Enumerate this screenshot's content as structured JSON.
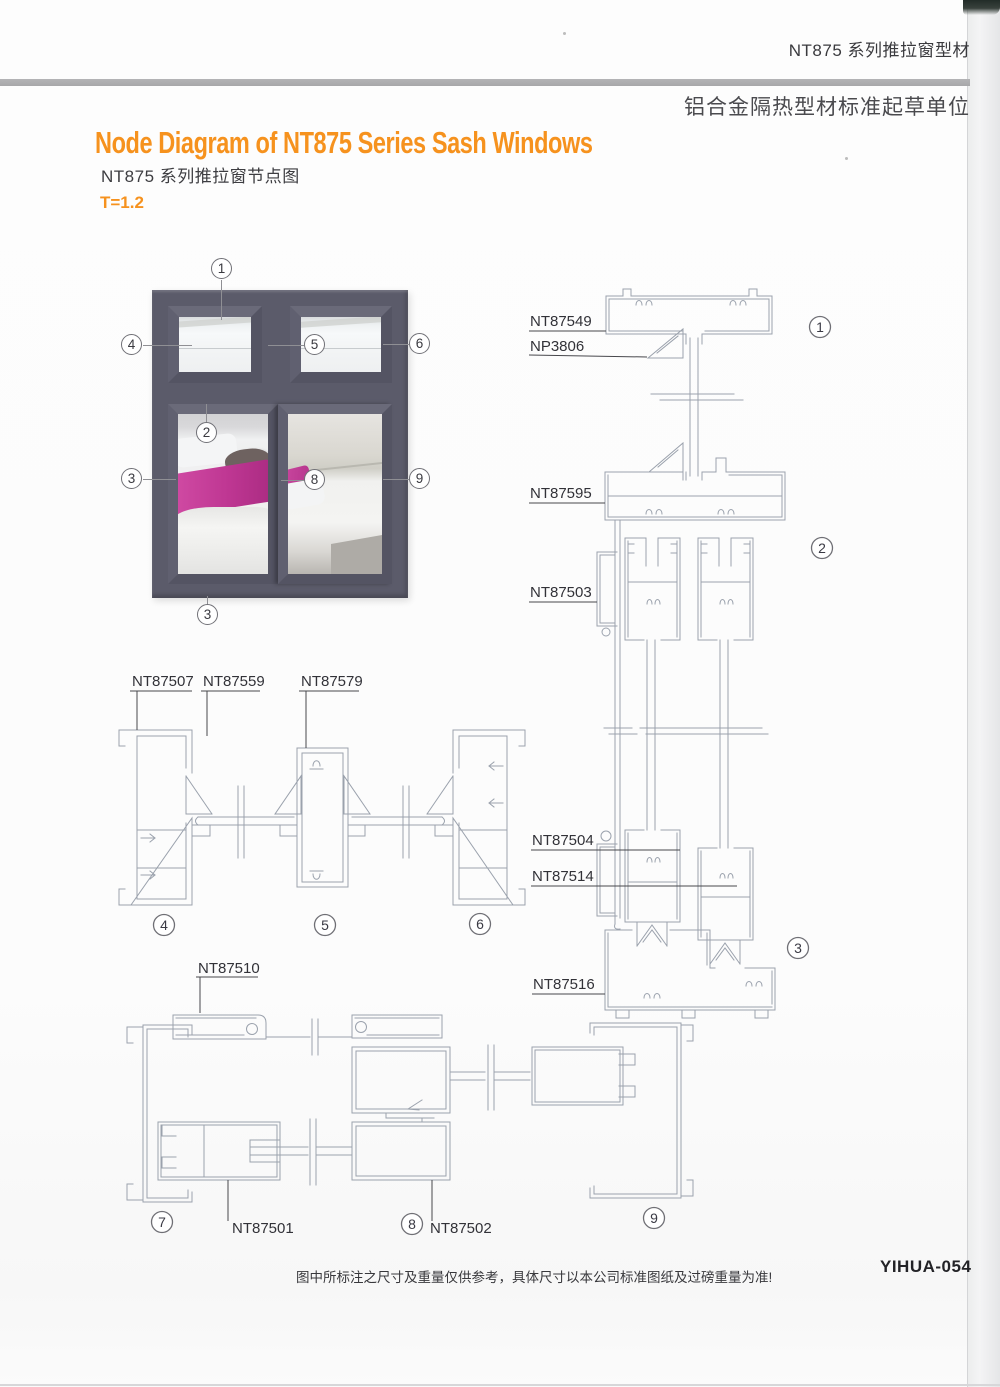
{
  "header": {
    "series": "NT875 系列推拉窗型材",
    "org": "铝合金隔热型材标准起草单位"
  },
  "title_en": "Node Diagram of NT875 Series Sash Windows",
  "title_zh": "NT875 系列推拉窗节点图",
  "thickness_note": "T=1.2",
  "colors": {
    "accent_orange": "#F6921E",
    "drawing_line": "#9BA2AD",
    "window_frame_gray": "#5B5B6A",
    "blanket_magenta": "#BF3793",
    "header_divider_gray": "#ABABAD"
  },
  "window_figure": {
    "callouts": {
      "c1": "1",
      "c2": "2",
      "c3_left": "3",
      "c3_bottom": "3",
      "c4": "4",
      "c5": "5",
      "c6": "6",
      "c8": "8",
      "c9": "9"
    }
  },
  "vertical_section": {
    "labels": {
      "head_frame": "NT87549",
      "glazing_bead": "NP3806",
      "mid_frame": "NT87595",
      "upper_block": "NT87503",
      "lower_block": "NT87504",
      "sash_bottom": "NT87514",
      "sill_frame": "NT87516"
    },
    "callouts": {
      "c1": "1",
      "c2": "2",
      "c3": "3"
    }
  },
  "top_section": {
    "labels": {
      "jamb": "NT87507",
      "fixed_sash": "NT87559",
      "mullion": "NT87579"
    },
    "callouts": {
      "c4": "4",
      "c5": "5",
      "c6": "6"
    }
  },
  "bottom_section": {
    "labels": {
      "track": "NT87510",
      "sash_left": "NT87501",
      "sash_right": "NT87502"
    },
    "callouts": {
      "c7": "7",
      "c8": "8",
      "c9": "9"
    }
  },
  "footer": {
    "disclaimer": "图中所标注之尺寸及重量仅供参考，具体尺寸以本公司标准图纸及过磅重量为准!",
    "page_code": "YIHUA-054"
  }
}
